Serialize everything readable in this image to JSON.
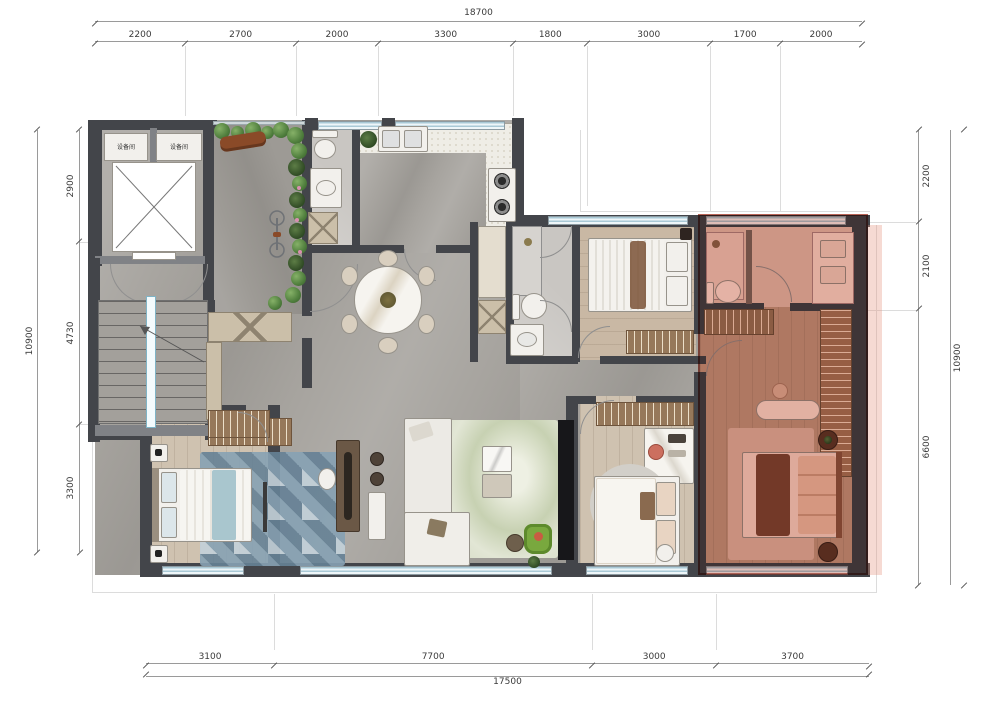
{
  "dimensions": {
    "top": {
      "total": "18700",
      "segments": [
        2200,
        2700,
        2000,
        3300,
        1800,
        3000,
        1700,
        2000
      ]
    },
    "bottom": {
      "total": "17500",
      "segments": [
        3100,
        7700,
        3000,
        3700
      ]
    },
    "left": {
      "total": "10900",
      "segments": [
        2900,
        4730,
        3300
      ]
    },
    "right": {
      "total": "10900",
      "segments": [
        2200,
        2100,
        6600
      ]
    }
  },
  "rooms": {
    "equipment_room_label": "设备间"
  },
  "legend": {
    "highlighted_area": "master-suite"
  },
  "colors": {
    "highlight": "#c8503c",
    "wall": "#43454a",
    "window": "#bcd6e0",
    "floor_marble": "#a7a49f",
    "floor_wood": "#cdbca9",
    "garden_green": "#557f3f",
    "master_tint": "rgba(203,82,60,0.34)"
  }
}
